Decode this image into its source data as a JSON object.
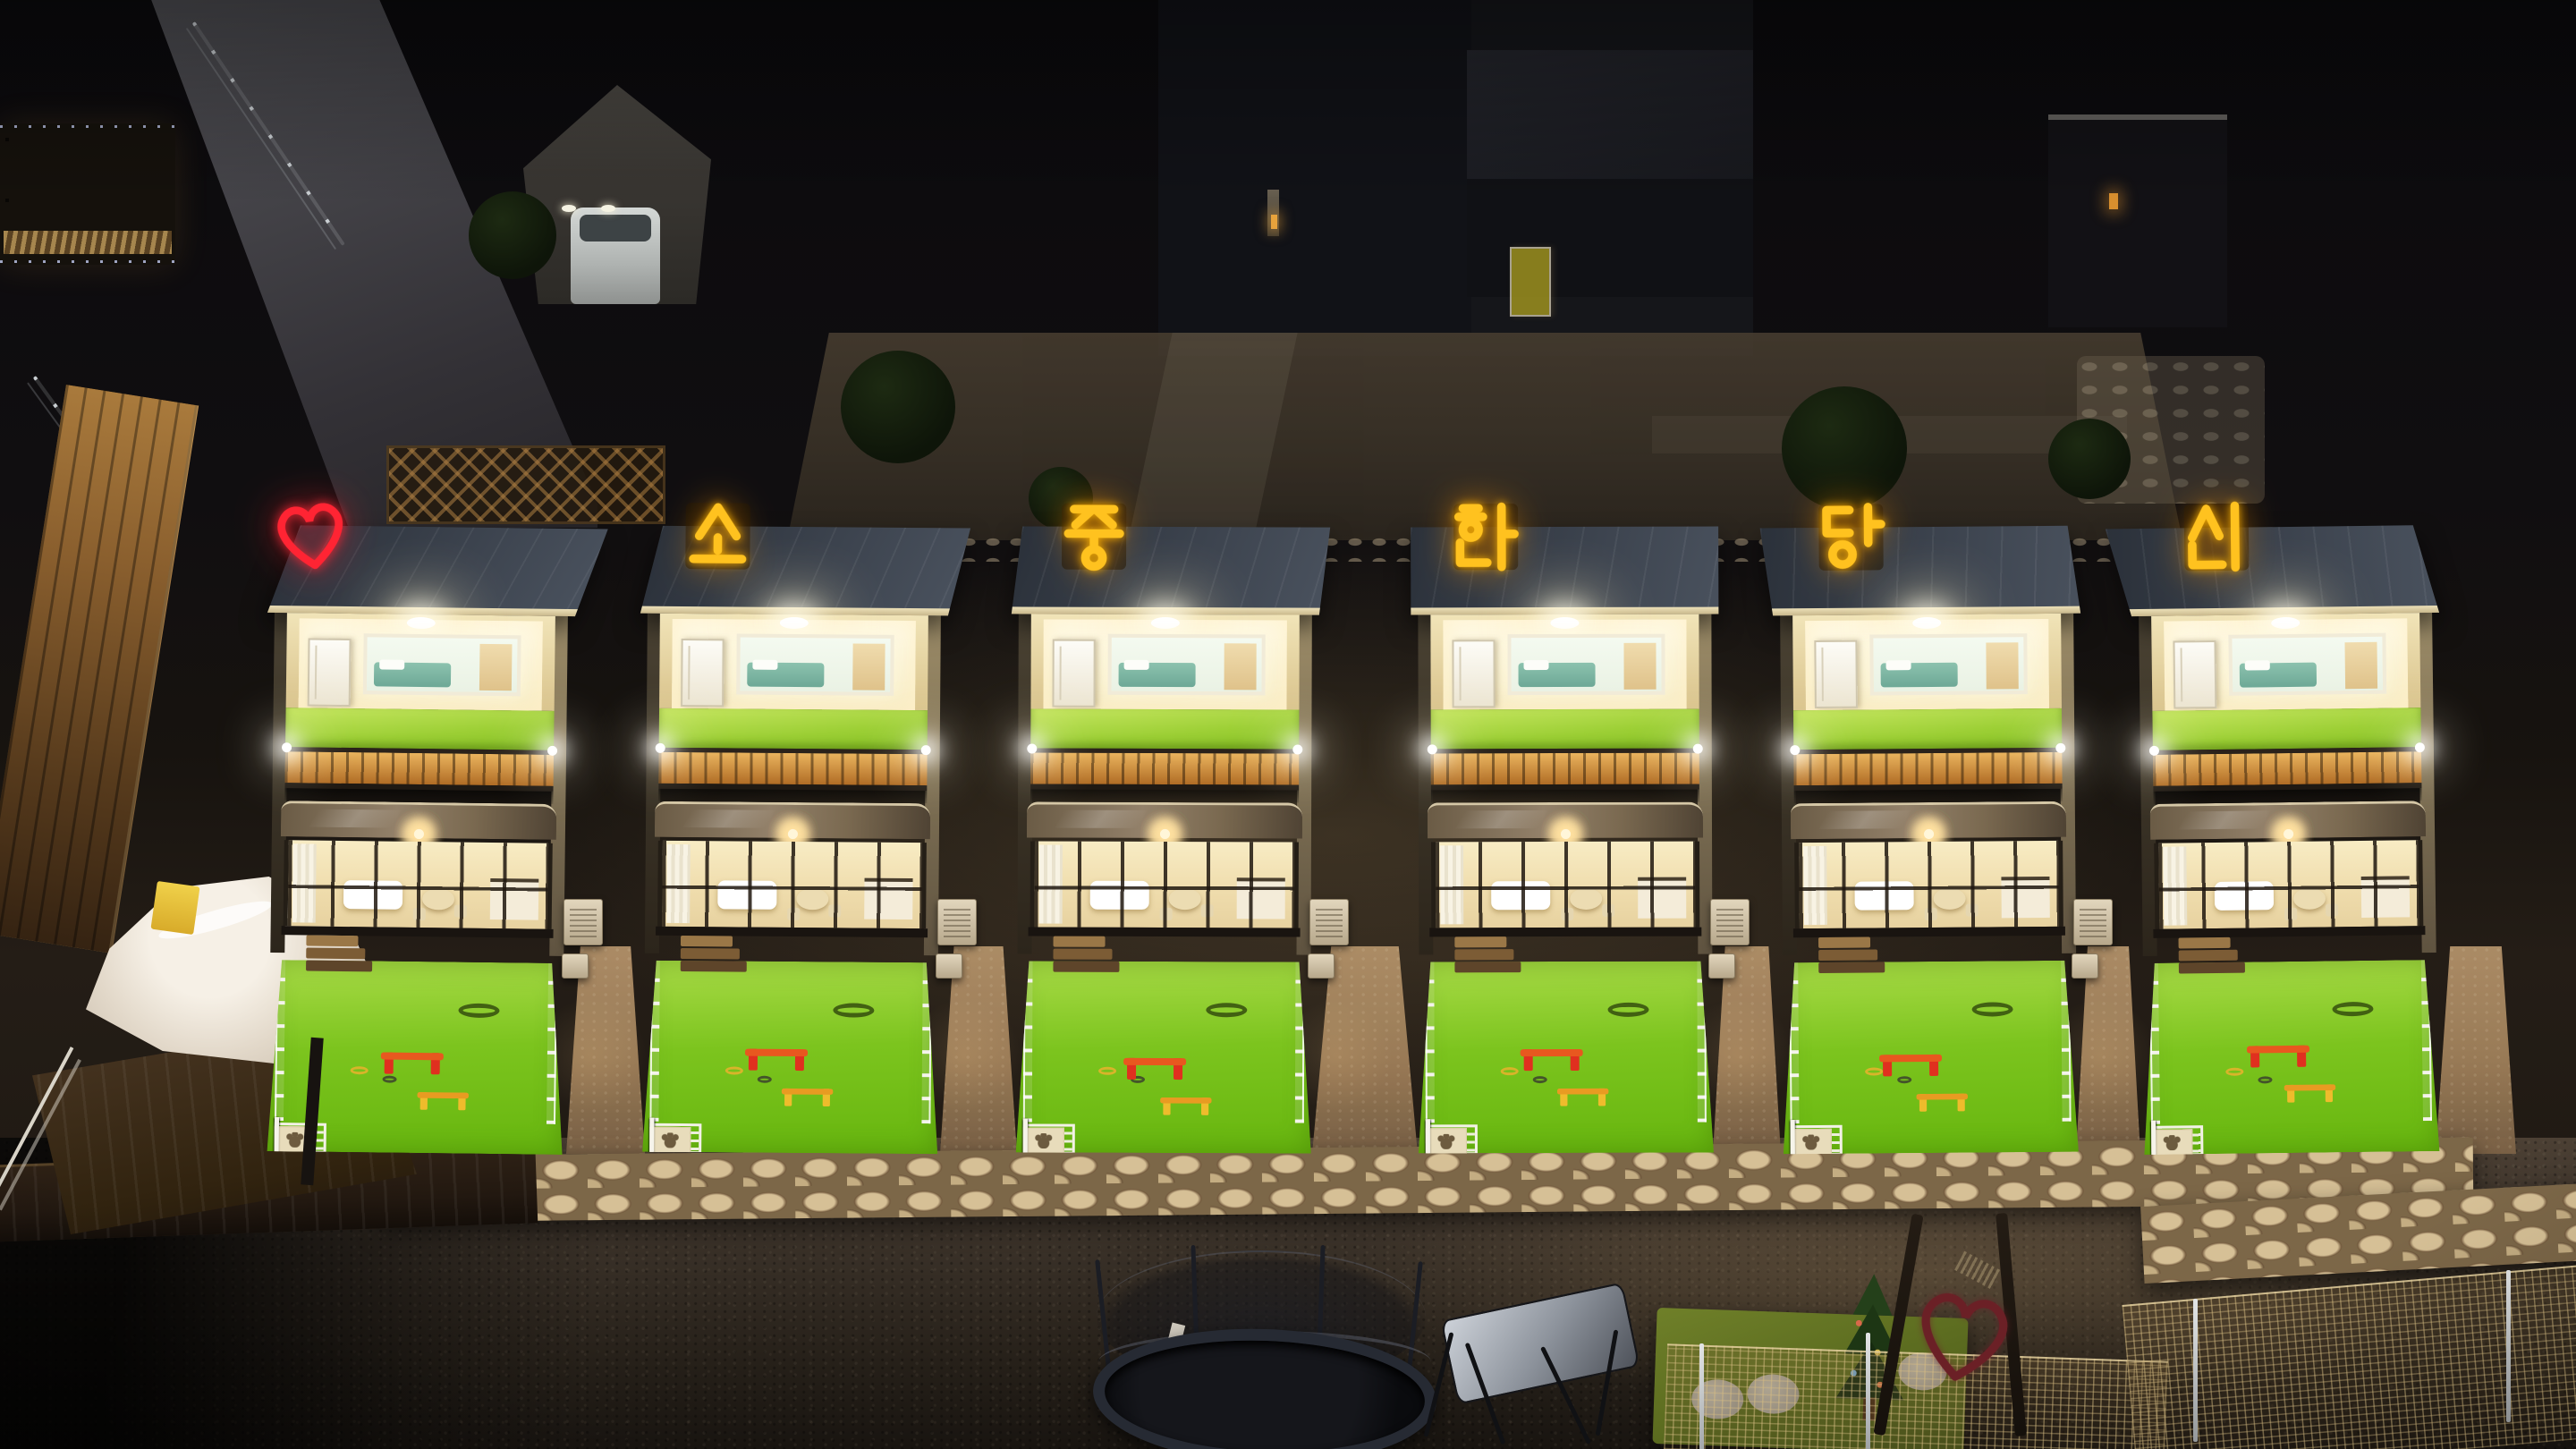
{
  "scene": {
    "setting": "night aerial photograph of a pet-friendly pension with six illuminated guesthouse units",
    "neon_sign": {
      "full_text": "소중한당신",
      "heart_symbol": "♡",
      "characters": [
        "소",
        "중",
        "한",
        "당",
        "신"
      ],
      "heart_color": "#ff2433",
      "text_color": "#ffc21f"
    },
    "units": [
      {
        "id": "unit-1",
        "sign_glyph": "♡",
        "sign_kind": "heart"
      },
      {
        "id": "unit-2",
        "sign_glyph": "소",
        "sign_kind": "hangul"
      },
      {
        "id": "unit-3",
        "sign_glyph": "중",
        "sign_kind": "hangul"
      },
      {
        "id": "unit-4",
        "sign_glyph": "한",
        "sign_kind": "hangul"
      },
      {
        "id": "unit-5",
        "sign_glyph": "당",
        "sign_kind": "hangul"
      },
      {
        "id": "unit-6",
        "sign_glyph": "신",
        "sign_kind": "hangul"
      }
    ],
    "palette": {
      "turf_green": "#8ec832",
      "yard_green": "#76c01c",
      "wood_railing": "#d1913f",
      "roof_slate": "#3a414b",
      "warm_glow": "#ffe9b4",
      "stone_path": "#cdb68c",
      "gravel": "#4e4236",
      "night_ground": "#0d0c0e"
    },
    "objects": {
      "trampoline": "trampoline-with-safety-net",
      "swing_bench": "canopy-swing-bench",
      "play_mat": "green-mat-with-christmas-tree-and-stepping-discs",
      "agility_hurdles": [
        "red-hurdle",
        "yellow-hurdle"
      ],
      "heart_gate": "metal-heart-between-two-poles",
      "covered_spa": "white-covered-tub-on-wooden-deck",
      "white_car": "white-car-under-tent-carport",
      "yard_fence": "white-picket-fence-with-paw-panels"
    }
  }
}
